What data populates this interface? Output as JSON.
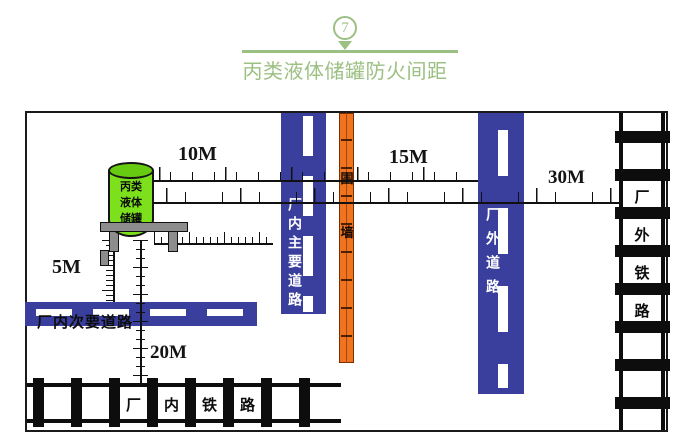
{
  "header": {
    "badge": "7",
    "title": "丙类液体储罐防火间距"
  },
  "colors": {
    "accent_green": "#9cc083",
    "road_blue": "#3a3f9e",
    "wall_orange": "#f07420",
    "tank_green": "#7ce01c",
    "support_gray": "#8d8d8d"
  },
  "tank": {
    "lines": [
      "丙类",
      "液体",
      "储罐"
    ]
  },
  "dims": {
    "d10": "10M",
    "d15": "15M",
    "d30": "30M",
    "d5": "5M",
    "d20": "20M"
  },
  "roads": {
    "main": "厂内主要道路",
    "outer": "厂外道路",
    "secondary": "厂内次要道路"
  },
  "wall": {
    "chars": [
      "围",
      "墙"
    ]
  },
  "railways": {
    "inner": {
      "chars": [
        "厂",
        "内",
        "铁",
        "路"
      ]
    },
    "outer": {
      "chars": [
        "厂",
        "外",
        "铁",
        "路"
      ]
    }
  }
}
